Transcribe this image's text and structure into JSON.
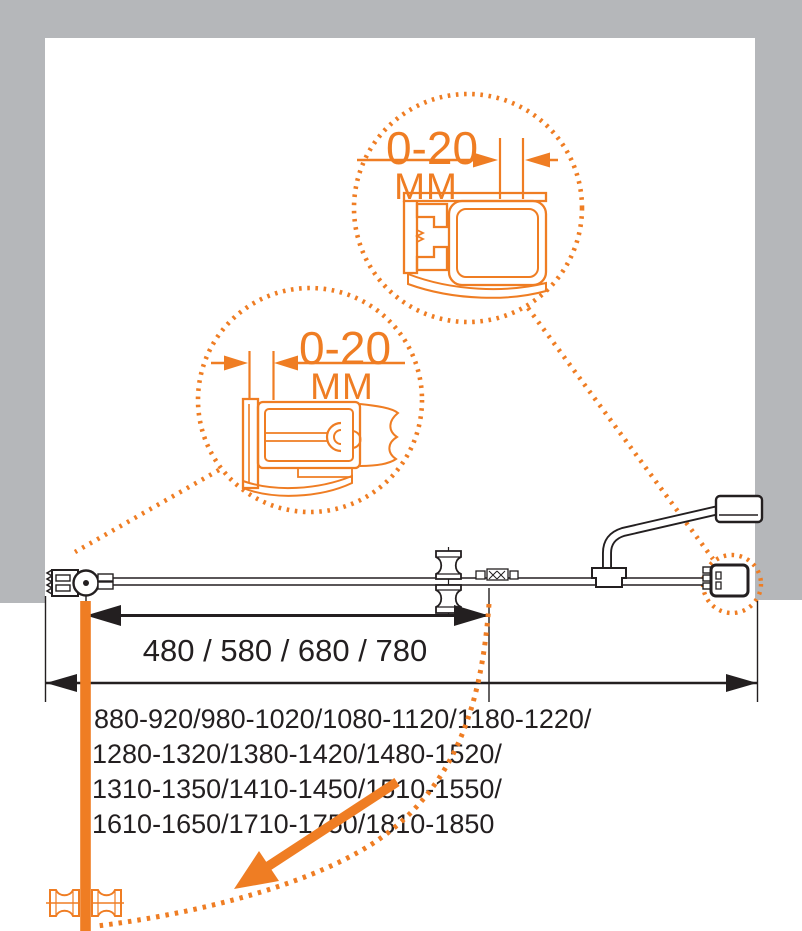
{
  "colors": {
    "accent_orange": "#EF7D23",
    "wall_gray": "#B5B7BA",
    "line_black": "#231F20"
  },
  "callouts": {
    "top_profile": {
      "value": "0-20",
      "unit": "ММ"
    },
    "bottom_profile": {
      "value": "0-20",
      "unit": "ММ"
    }
  },
  "dimensions": {
    "door_width_options": "480 / 580 / 680 / 780",
    "overall_width_ranges": [
      "880-920/980-1020/1080-1120/1180-1220/",
      "1280-1320/1380-1420/1480-1520/",
      "1310-1350/1410-1450/1510-1550/",
      "1610-1650/1710-1750/1810-1850"
    ]
  },
  "icons": {
    "pivot_hinge": "pivot-hinge",
    "door_knob": "spool-knob",
    "towel_handle": "curved-handle",
    "wall_profile_top": "adjustable-wall-profile",
    "wall_profile_bottom": "adjustable-wall-profile",
    "swing_arrow": "door-swing-direction"
  }
}
